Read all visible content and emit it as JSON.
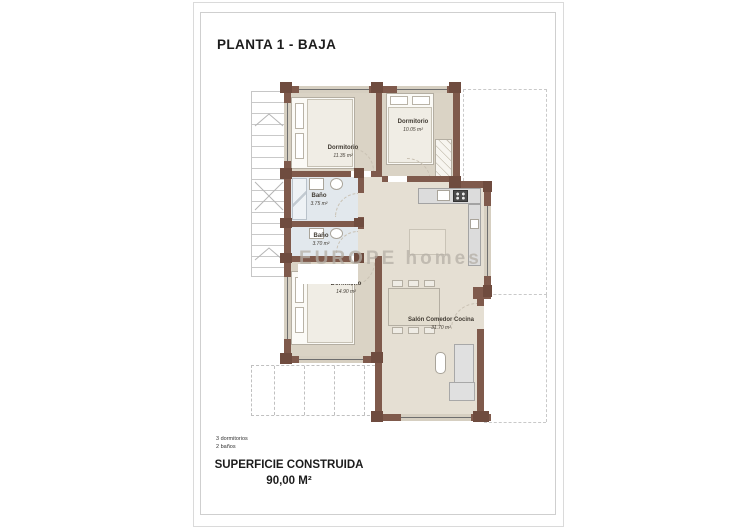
{
  "page": {
    "title": "PLANTA 1 - BAJA",
    "watermark": "EUROPE homes",
    "footer": {
      "line1": "3 dormitorios",
      "line2": "2 baños",
      "area_label": "SUPERFICIE CONSTRUIDA",
      "area_value": "90,00 M²"
    }
  },
  "rooms": [
    {
      "id": "bedroom-top-left",
      "name": "Dormitorio",
      "area": "11.35 m²"
    },
    {
      "id": "bedroom-top-right",
      "name": "Dormitorio",
      "area": "10.05 m²"
    },
    {
      "id": "bath-1",
      "name": "Baño",
      "area": "3.75 m²"
    },
    {
      "id": "bath-2",
      "name": "Baño",
      "area": "3.70 m²"
    },
    {
      "id": "bedroom-bottom-left",
      "name": "Dormitorio",
      "area": "14.90 m²"
    },
    {
      "id": "living-kitchen",
      "name": "Salón Comedor Cocina",
      "area": "31.70 m²"
    }
  ],
  "colors": {
    "wall": "#7f5a4c",
    "wall_pillar": "#6f4c3f",
    "floor_bedroom": "#dad3c5",
    "floor_living": "#e5dfd3",
    "floor_bath": "#e2e8ed",
    "window_band": "#d6cfc1",
    "kitchen_counter": "#dcdcdc",
    "dashed_outline": "#c9c9c9"
  }
}
